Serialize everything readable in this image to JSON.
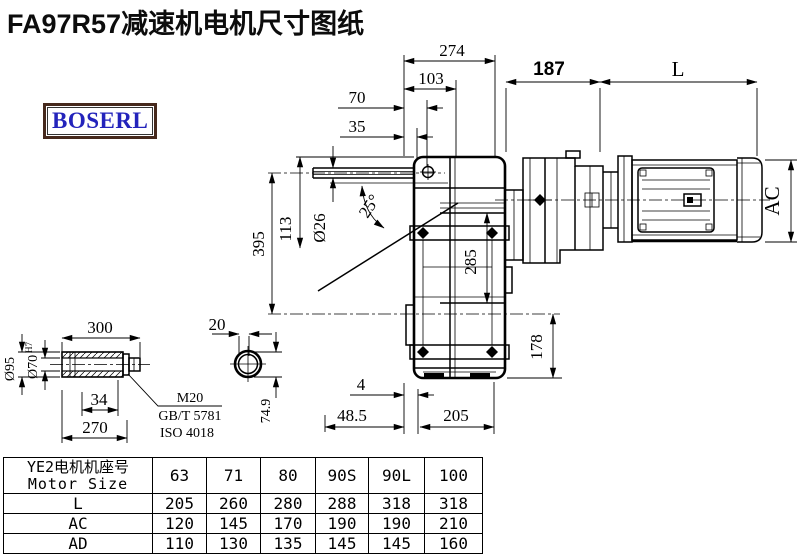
{
  "title": "FA97R57减速机电机尺寸图纸",
  "logo": "BOSERL",
  "drawing": {
    "dims": {
      "d274": "274",
      "d103": "103",
      "d70": "70",
      "d35": "35",
      "d187": "187",
      "dL": "L",
      "dAC": "AC",
      "d395": "395",
      "d113": "113",
      "d26": "Ø26",
      "angle": "25°",
      "d285": "285",
      "d178": "178",
      "d4": "4",
      "d48_5": "48.5",
      "d205": "205",
      "d300": "300",
      "d20": "20",
      "d95": "Ø95",
      "d70h": "Ø70",
      "d70h_sup": "H7",
      "d34": "34",
      "d270": "270",
      "d74_9": "74.9",
      "m20": "M20",
      "gb": "GB/T 5781",
      "iso": "ISO 4018"
    }
  },
  "table": {
    "header_cn": "YE2电机机座号",
    "header_en": "Motor Size",
    "sizes": [
      "63",
      "71",
      "80",
      "90S",
      "90L",
      "100"
    ],
    "rows": [
      {
        "label": "L",
        "values": [
          "205",
          "260",
          "280",
          "288",
          "318",
          "318"
        ]
      },
      {
        "label": "AC",
        "values": [
          "120",
          "145",
          "170",
          "190",
          "190",
          "210"
        ]
      },
      {
        "label": "AD",
        "values": [
          "110",
          "130",
          "135",
          "145",
          "145",
          "160"
        ]
      }
    ]
  },
  "colors": {
    "line": "#000000",
    "logo_text": "#2323bb",
    "logo_border": "#46291d",
    "bg": "#ffffff"
  }
}
